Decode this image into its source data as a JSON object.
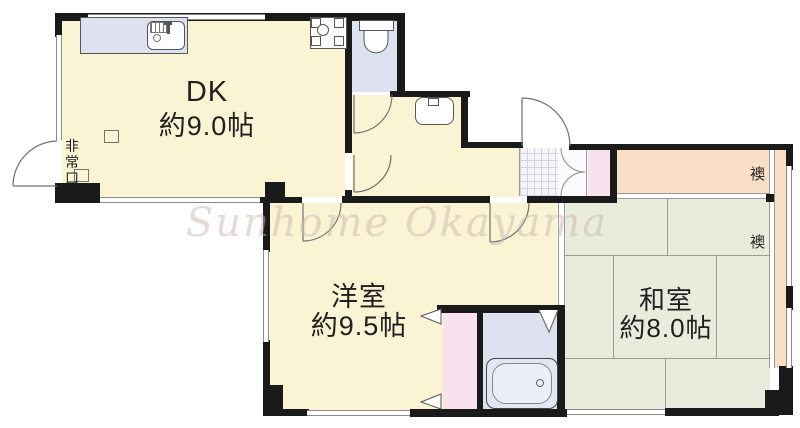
{
  "watermark": "Sunhome Okayama",
  "rooms": {
    "dk": {
      "name": "DK",
      "size": "約9.0帖"
    },
    "western": {
      "name": "洋室",
      "size": "約9.5帖"
    },
    "japanese": {
      "name": "和室",
      "size": "約8.0帖"
    }
  },
  "labels": {
    "emergency_exit": "非常口",
    "fusuma_upper": "襖",
    "fusuma_lower": "襖"
  },
  "fixtures": [
    "kitchen-counter",
    "kitchen-sink",
    "gas-stove",
    "toilet",
    "washbasin",
    "bathtub",
    "entrance-tile",
    "shoe-cabinet",
    "folding-door",
    "sliding-door-markers",
    "emergency-exit-door"
  ],
  "palette": {
    "room_cream": "#faf3d4",
    "tatami_green": "#e9ecdc",
    "tatami_line": "#99a087",
    "closet_peach": "#f8dfc6",
    "wet_area_lavender": "#dee1f0",
    "dressing_pink": "#f7e2ee",
    "wall_black": "#1a1a1a",
    "watermark_color": "#cbb6ae"
  }
}
